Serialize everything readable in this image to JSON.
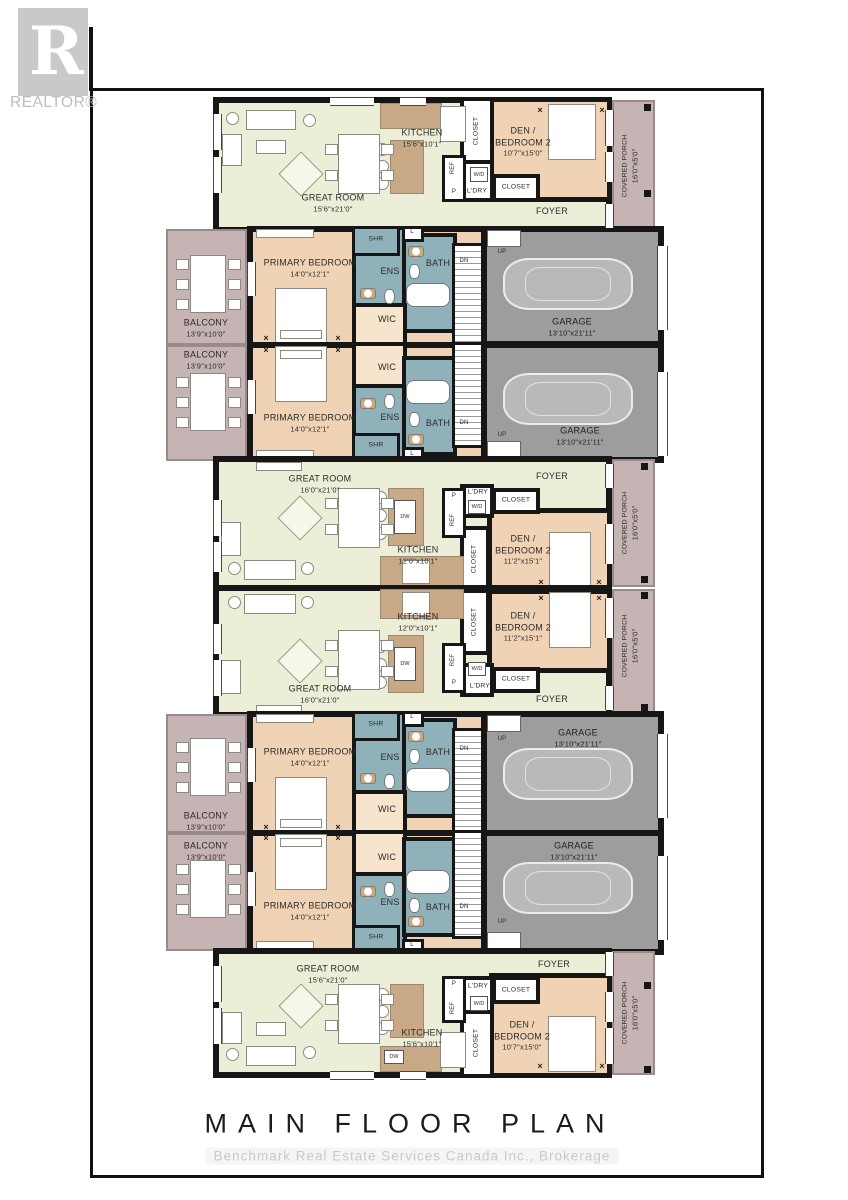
{
  "title": "MAIN FLOOR PLAN",
  "watermark": "Benchmark Real Estate Services Canada Inc.,  Brokerage",
  "logo": {
    "letter": "R",
    "text": "REALTOR®"
  },
  "r": {
    "great_a": {
      "n": "GREAT ROOM",
      "d": "15'6\"x21'0\""
    },
    "great_b": {
      "n": "GREAT ROOM",
      "d": "16'0\"x21'0\""
    },
    "kitchen_a": {
      "n": "KITCHEN",
      "d": "15'6\"x10'1\""
    },
    "kitchen_b": {
      "n": "KITCHEN",
      "d": "12'0\"x10'1\""
    },
    "den_a": {
      "n1": "DEN /",
      "n2": "BEDROOM 2",
      "d": "10'7\"x15'0\""
    },
    "den_b": {
      "n1": "DEN /",
      "n2": "BEDROOM 2",
      "d": "11'2\"x15'1\""
    },
    "primary": {
      "n": "PRIMARY BEDROOM",
      "d": "14'0\"x12'1\""
    },
    "garage": {
      "n": "GARAGE",
      "d": "13'10\"x21'11\""
    },
    "balcony": {
      "n": "BALCONY",
      "d": "13'9\"x10'0\""
    },
    "porch": {
      "n": "COVERED PORCH",
      "d": "16'0\"x5'0\""
    },
    "foyer": "FOYER",
    "wic": "WIC",
    "ens": "ENS",
    "bath": "BATH",
    "shr": "SHR",
    "ldry": "L'DRY",
    "wd": "W/D",
    "closet": "CLOSET",
    "ref": "REF",
    "p": "P",
    "dw": "DW",
    "l": "L",
    "up": "UP",
    "dn": "DN"
  }
}
